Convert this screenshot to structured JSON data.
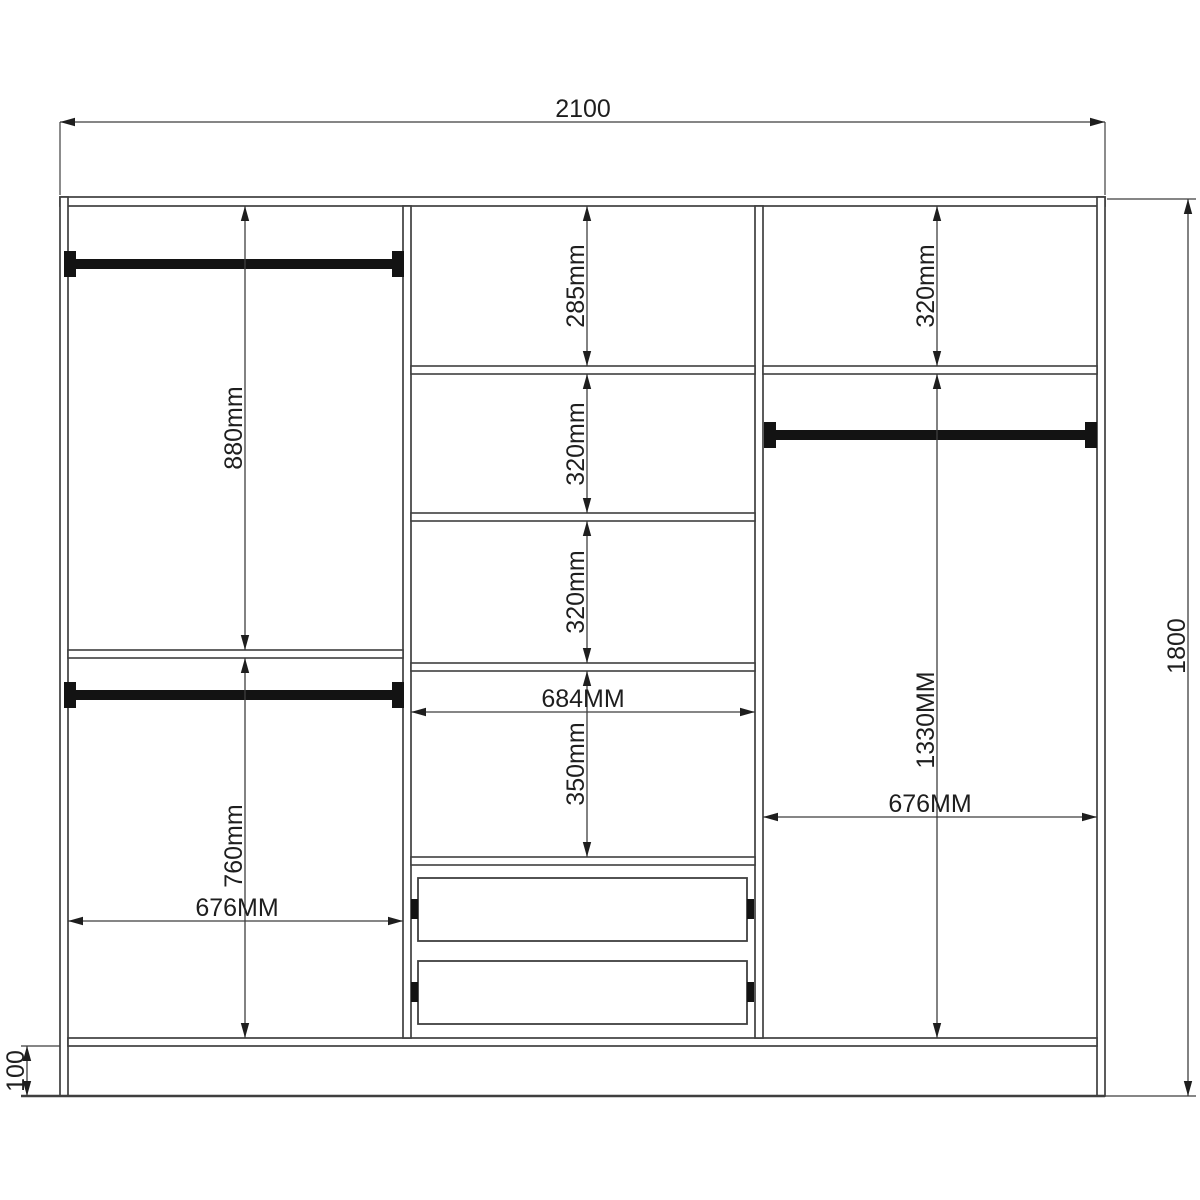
{
  "drawing": {
    "title": "wardrobe-internal-dimensions-technical-drawing",
    "colors": {
      "background": "#ffffff",
      "line": "#3f3f3f",
      "text": "#1e1e1e",
      "rail": "#131313"
    },
    "components": {
      "section_count": 3,
      "hanging_rail_count": 3,
      "drawer_count": 2,
      "shelf_count": 6
    },
    "dimensions": {
      "overall_width": {
        "label": "2100",
        "value_mm": 2100
      },
      "overall_height": {
        "label": "1800",
        "value_mm": 1800
      },
      "plinth_height": {
        "label": "100",
        "value_mm": 100
      },
      "left_hanging_height": {
        "label": "880mm",
        "value_mm": 880
      },
      "left_lower_height": {
        "label": "760mm",
        "value_mm": 760
      },
      "left_width": {
        "label": "676MM",
        "value_mm": 676
      },
      "middle_top_gap": {
        "label": "285mm",
        "value_mm": 285
      },
      "middle_shelf_gap_1": {
        "label": "320mm",
        "value_mm": 320
      },
      "middle_shelf_gap_2": {
        "label": "320mm",
        "value_mm": 320
      },
      "middle_drawer_gap": {
        "label": "350mm",
        "value_mm": 350
      },
      "middle_width": {
        "label": "684MM",
        "value_mm": 684
      },
      "right_top_gap": {
        "label": "320mm",
        "value_mm": 320
      },
      "right_hanging_height": {
        "label": "1330MM",
        "value_mm": 1330
      },
      "right_width": {
        "label": "676MM",
        "value_mm": 676
      }
    }
  }
}
